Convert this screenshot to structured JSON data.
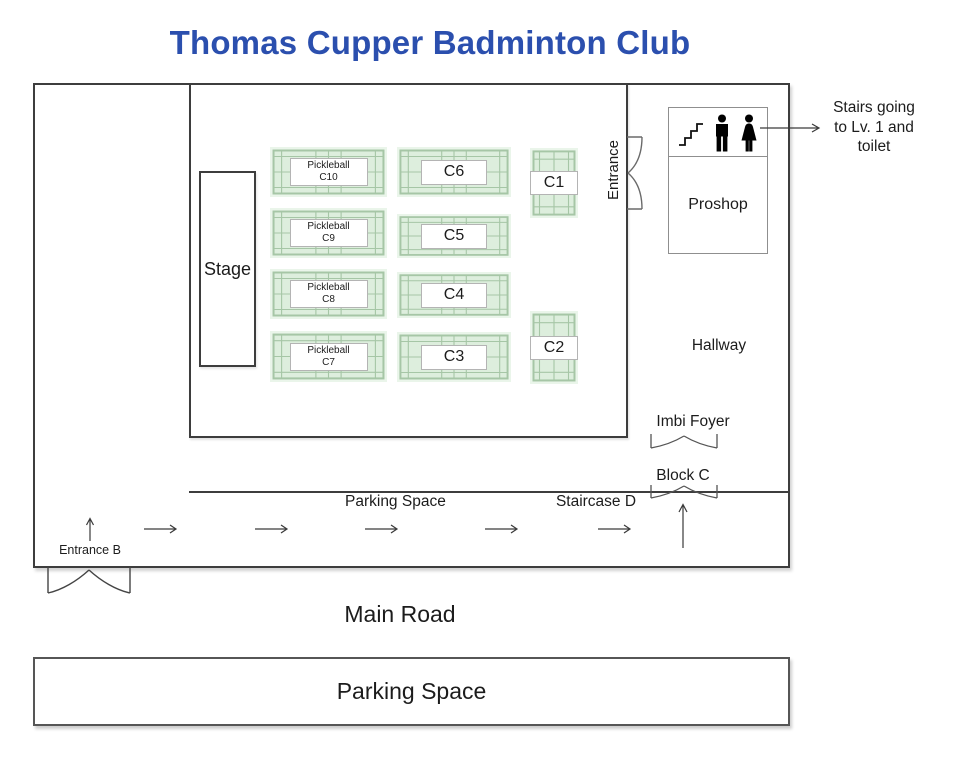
{
  "title": "Thomas Cupper Badminton Club",
  "colors": {
    "title_blue": "#2b4fae",
    "wall_gray": "#3d3d3d",
    "court_fill": "#ddeedd",
    "court_pad": "#eaf5ea",
    "court_line": "#a6c6a6"
  },
  "courts": {
    "c10": {
      "line1": "Pickleball",
      "line2": "C10"
    },
    "c9": {
      "line1": "Pickleball",
      "line2": "C9"
    },
    "c8": {
      "line1": "Pickleball",
      "line2": "C8"
    },
    "c7": {
      "line1": "Pickleball",
      "line2": "C7"
    },
    "c6": {
      "label": "C6"
    },
    "c5": {
      "label": "C5"
    },
    "c4": {
      "label": "C4"
    },
    "c3": {
      "label": "C3"
    },
    "c1": {
      "label": "C1"
    },
    "c2": {
      "label": "C2"
    }
  },
  "labels": {
    "stage": "Stage",
    "entrance": "Entrance",
    "proshop": "Proshop",
    "hallway": "Hallway",
    "imbi_foyer": "Imbi Foyer",
    "block_c": "Block C",
    "staircase_d": "Staircase D",
    "parking_mid": "Parking Space",
    "entrance_b": "Entrance B",
    "main_road": "Main Road",
    "parking_bottom": "Parking Space"
  },
  "annotation": {
    "line1": "Stairs going",
    "line2": "to Lv. 1 and",
    "line3": "toilet"
  },
  "icons": {
    "stairs": "stairs-icon",
    "man": "man-icon",
    "woman": "woman-icon",
    "double_door": "double-door-icon",
    "right_arrow": "right-arrow-icon",
    "up_arrow": "up-arrow-icon"
  }
}
